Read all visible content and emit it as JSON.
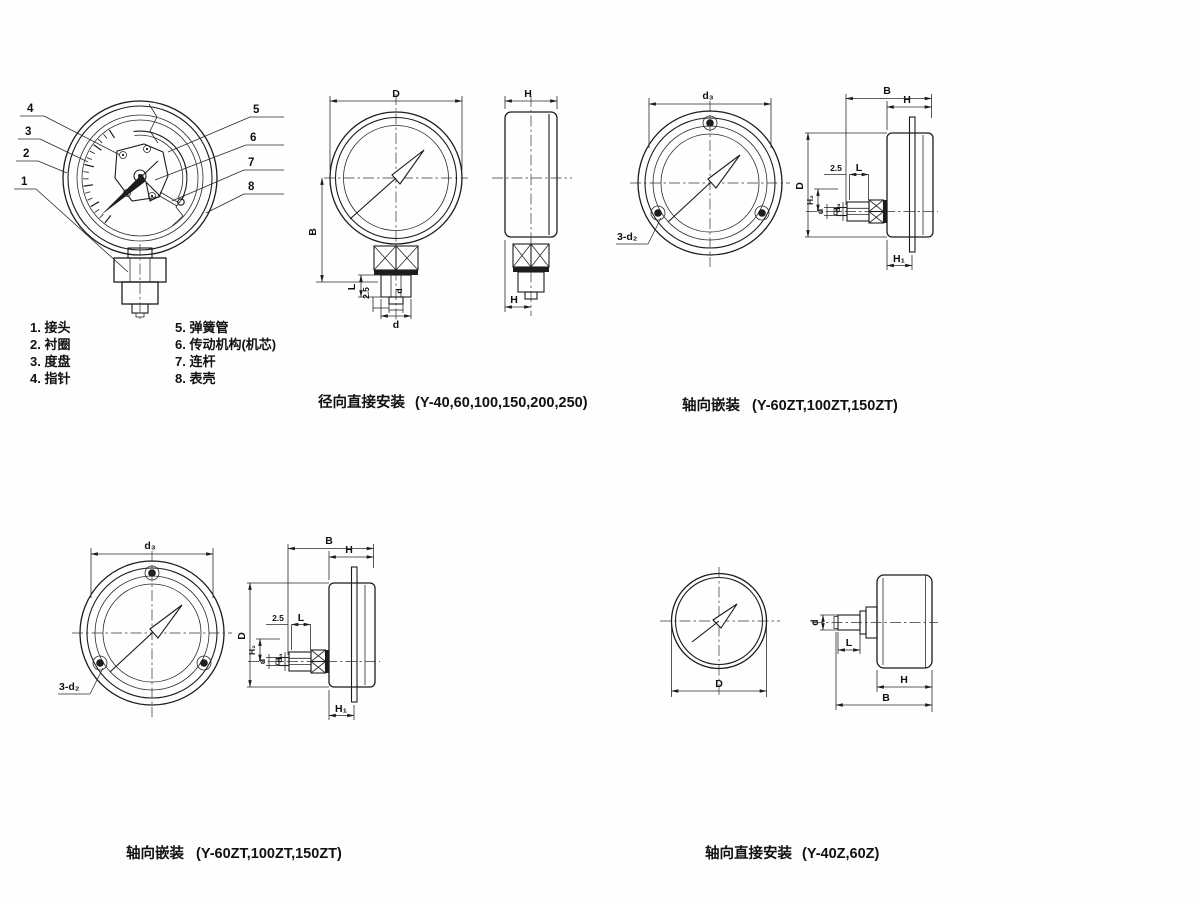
{
  "cutaway": {
    "callouts": [
      "1",
      "2",
      "3",
      "4",
      "5",
      "6",
      "7",
      "8"
    ]
  },
  "parts_list": {
    "left": [
      "1. 接头",
      "2. 衬圈",
      "3. 度盘",
      "4. 指针"
    ],
    "right": [
      "5. 弹簧管",
      "6. 传动机构(机芯)",
      "7. 连杆",
      "8. 表壳"
    ]
  },
  "captions": {
    "radial_direct_title": "径向直接安装",
    "radial_direct_models": "(Y-40,60,100,150,200,250)",
    "axial_embedded_title": "轴向嵌装",
    "axial_embedded_models": "(Y-60ZT,100ZT,150ZT)",
    "axial_direct_title": "轴向直接安装",
    "axial_direct_models": "(Y-40Z,60Z)"
  },
  "dim_labels": {
    "D": "D",
    "H": "H",
    "B": "B",
    "L": "L",
    "d": "d",
    "d3": "d₃",
    "d4": "d₄",
    "H1": "H₁",
    "H2": "H₂",
    "gap": "2.5",
    "three_d2": "3-d₂"
  },
  "colors": {
    "ink": "#1c1c1c",
    "paper": "#fefefe"
  }
}
